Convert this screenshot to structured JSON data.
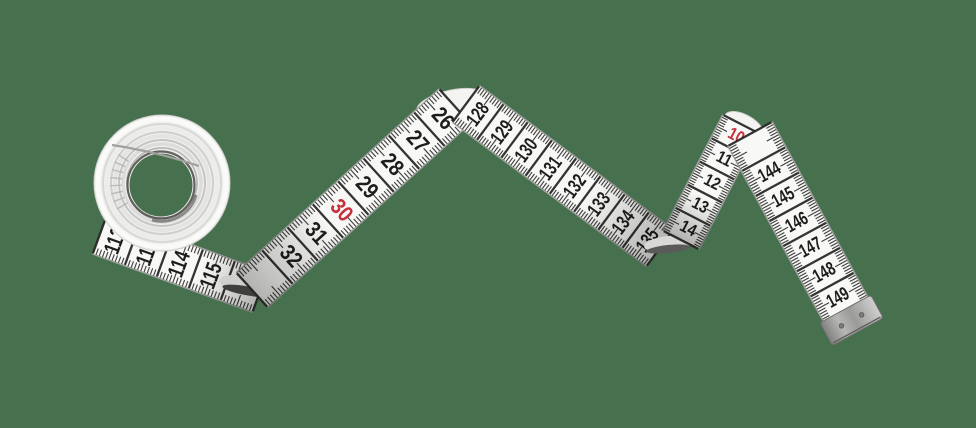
{
  "scene": {
    "subject": "tailor-measuring-tape",
    "background_color": "#47704F",
    "tape": {
      "face_color": "#f8f8f6",
      "edge_line_color": "rgba(45,45,43,0.45)",
      "tick_color": "#2a2a28",
      "cm_line_color": "#242422",
      "number_color": "#1d1d1b",
      "highlight_number_color": "#c5303a",
      "metal_tip_color": "#a9a9a7",
      "rivet_count": 2
    }
  },
  "tape_scale_segments": [
    {
      "id": "coil-underside",
      "numbers": [
        "112",
        "113",
        "114",
        "115"
      ],
      "red_numbers": []
    },
    {
      "id": "rise-to-first-peak",
      "numbers": [
        "32",
        "31",
        "30",
        "29",
        "28",
        "27",
        "26"
      ],
      "red_numbers": [
        "30"
      ]
    },
    {
      "id": "descent-from-first-peak",
      "numbers": [
        "128",
        "129",
        "130",
        "131",
        "132",
        "133",
        "134",
        "135"
      ],
      "red_numbers": []
    },
    {
      "id": "rise-to-second-peak",
      "numbers": [
        "14",
        "13",
        "12",
        "11",
        "10"
      ],
      "red_numbers": [
        "10"
      ]
    },
    {
      "id": "descent-to-tip",
      "numbers": [
        "144",
        "145",
        "146",
        "147",
        "148",
        "149"
      ],
      "red_numbers": []
    }
  ]
}
